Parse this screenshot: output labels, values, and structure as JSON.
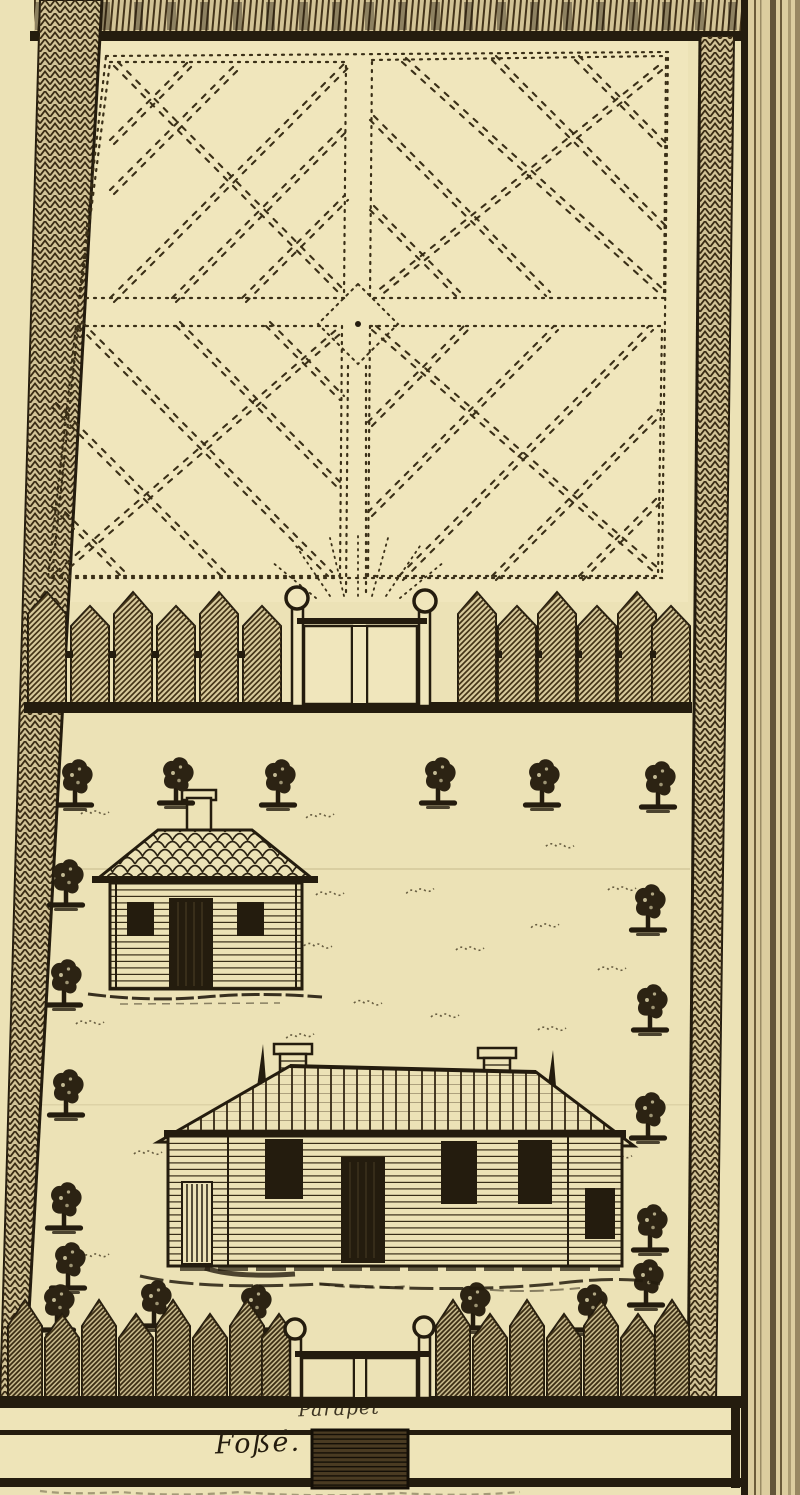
{
  "plate": {
    "labels": {
      "parapet": "Parapet",
      "fosse": "Foßé."
    },
    "colors": {
      "paper": "#ece2b6",
      "garden_paper": "#f0e6bc",
      "ink": "#241c0e",
      "hatch_fill": "#d7c99b",
      "page_edge_strip": "#dccd9f"
    },
    "scene_elements": [
      "boundary-wall",
      "parterre-garden",
      "garden-center-diamond",
      "inner-palisade-fence",
      "inner-gate",
      "courtyard",
      "trees",
      "small-cabin",
      "main-house",
      "outer-palisade-fence",
      "outer-gate",
      "parapet-strip",
      "moat-strip",
      "bridge",
      "page-edge"
    ]
  }
}
